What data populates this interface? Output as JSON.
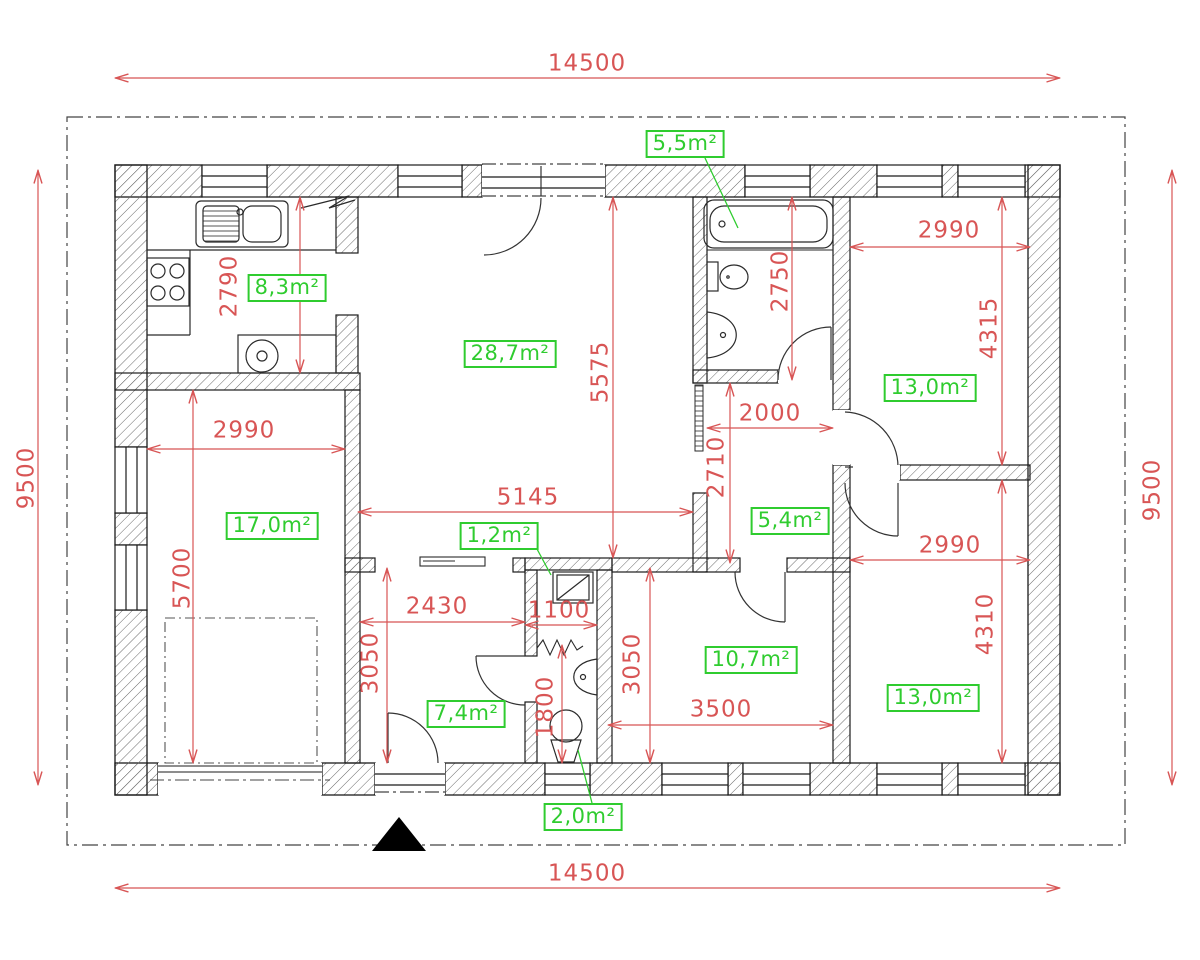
{
  "overall": {
    "width": "14500",
    "depth": "9500"
  },
  "rooms": {
    "kitchen": {
      "area": "8,3m²",
      "depth": "2790"
    },
    "living_room": {
      "area": "28,7m²",
      "width": "5145",
      "depth": "5575"
    },
    "bathroom": {
      "area": "5,5m²",
      "depth": "2750"
    },
    "room_left": {
      "area": "17,0m²",
      "width": "2990",
      "depth": "5700"
    },
    "bedroom_top_right": {
      "area": "13,0m²",
      "width": "2990",
      "depth": "4315"
    },
    "hallway": {
      "area": "5,4m²",
      "width": "2000",
      "depth": "2710"
    },
    "bedroom_bottom_right": {
      "area": "13,0m²",
      "width": "2990",
      "depth": "4310"
    },
    "entry_hall": {
      "area": "7,4m²",
      "width": "2430",
      "depth": "3050"
    },
    "wc": {
      "area": "2,0m²",
      "width": "1100",
      "depth": "1800"
    },
    "room_bottom_middle": {
      "area": "10,7m²",
      "width": "3500",
      "depth": "3050"
    },
    "closet": {
      "area": "1,2m²"
    }
  },
  "colors": {
    "dimension_red": "#d85555",
    "area_green": "#2fcc2f",
    "wall": "#1b1b1b",
    "background": "#ffffff"
  },
  "symbols": {
    "entrance_marker": "filled-black-triangle",
    "site_boundary": "dash-dot-line",
    "vent_flue": "zigzag"
  },
  "fixtures": [
    "kitchen-double-sink",
    "cooktop-4-burner",
    "round-appliance",
    "washing-machine",
    "bathtub",
    "toilet",
    "wash-basin",
    "wc-toilet",
    "wc-wash-basin",
    "wardrobe-mirror"
  ]
}
